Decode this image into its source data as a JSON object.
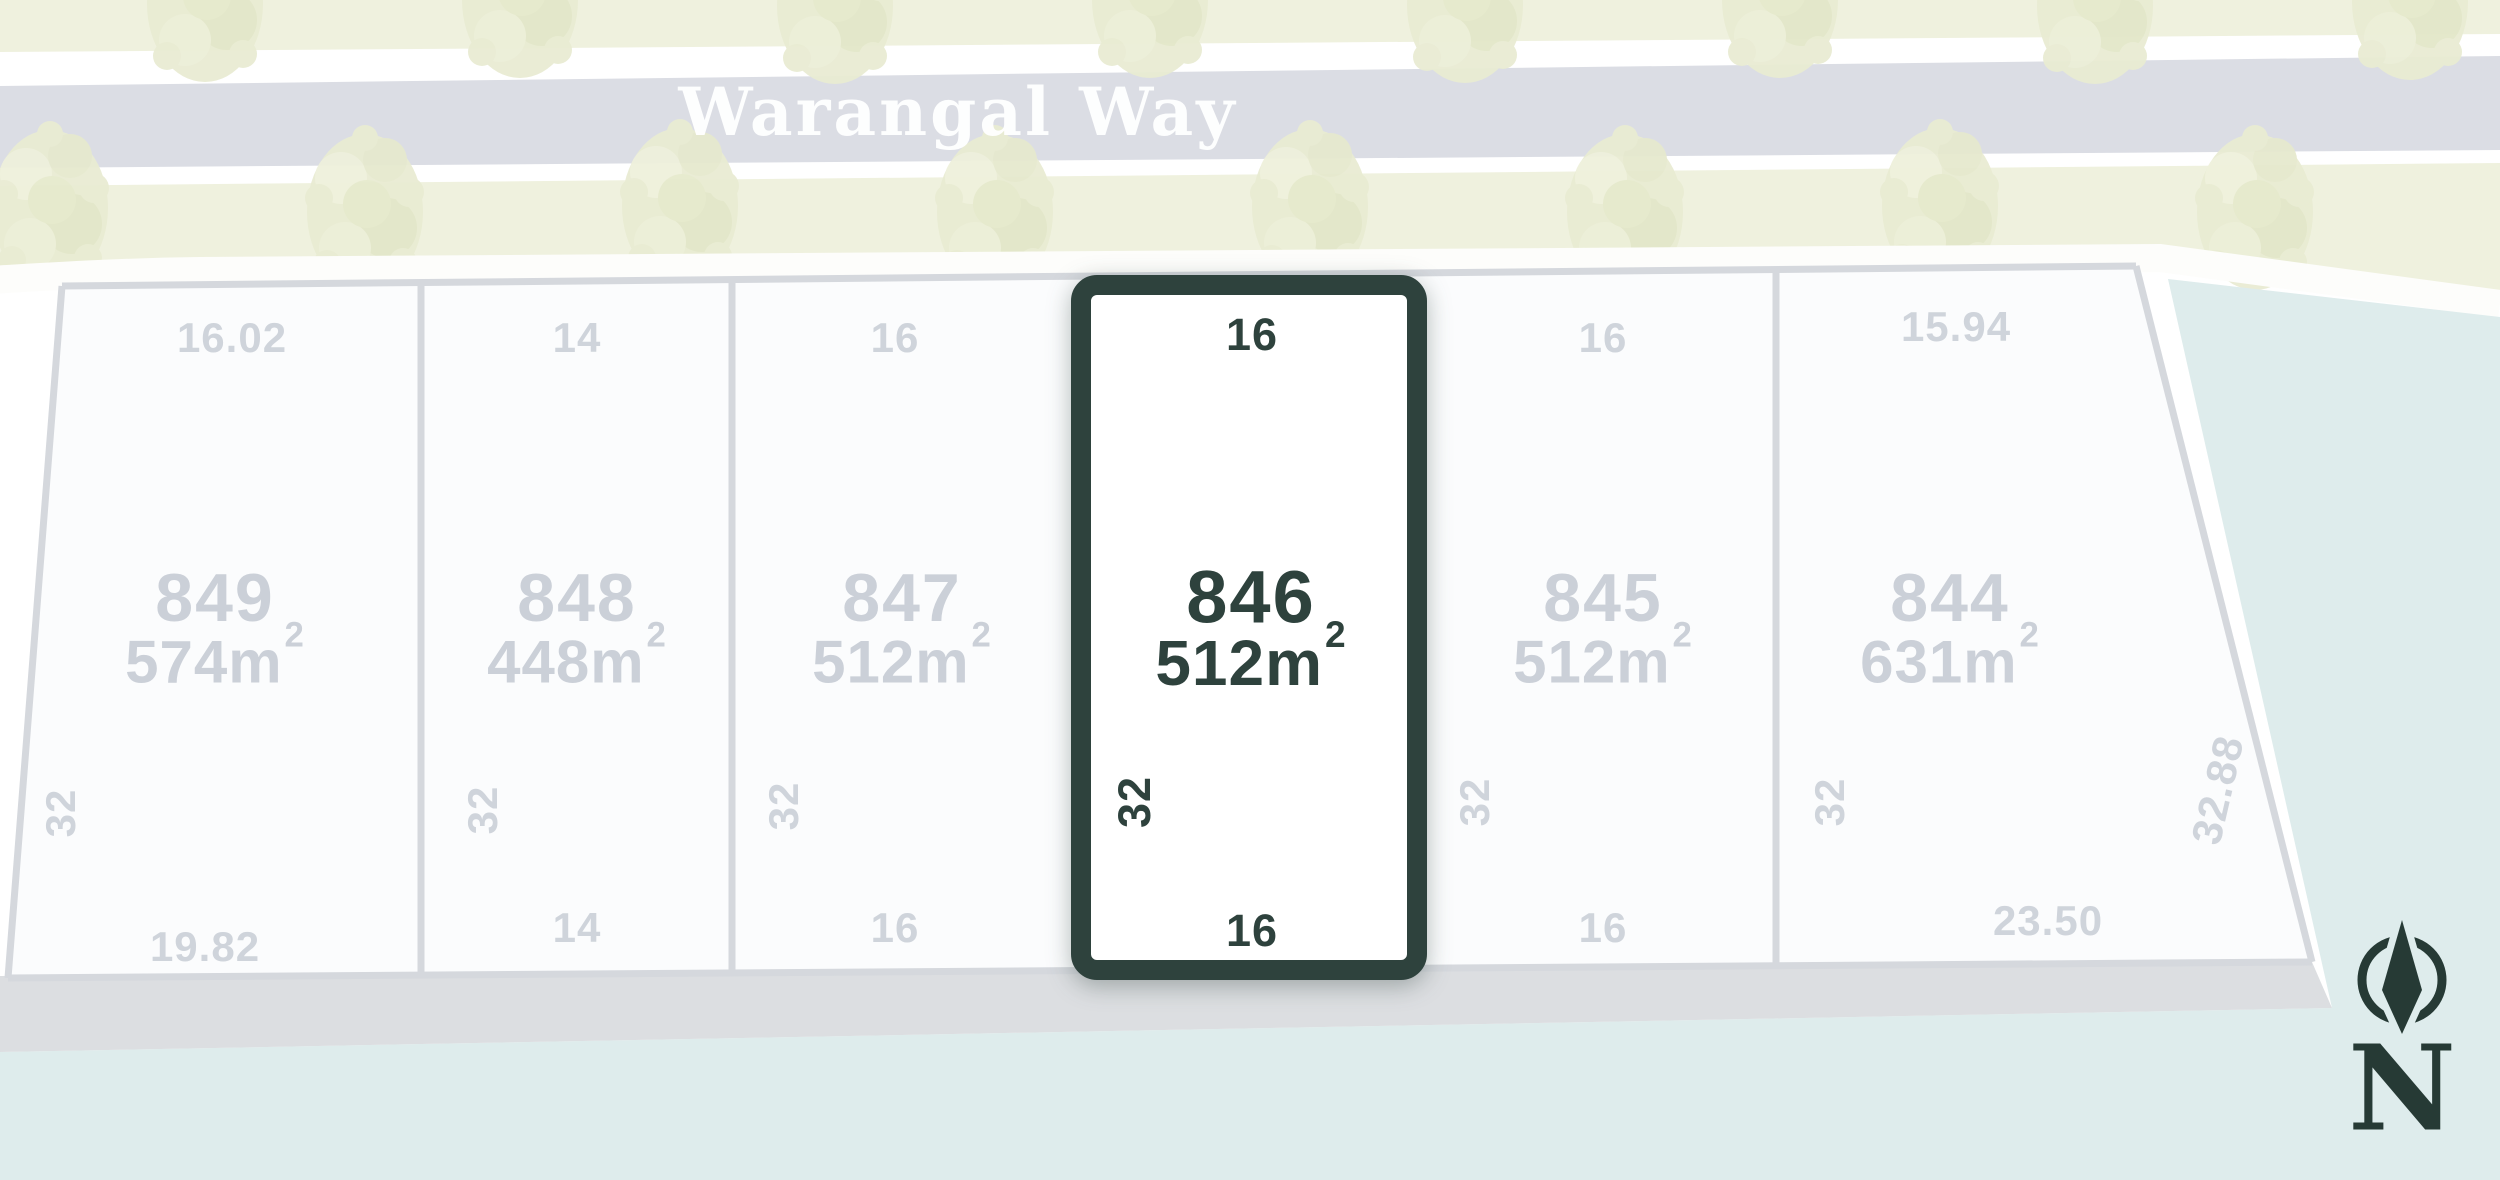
{
  "street": {
    "name": "Warangal Way"
  },
  "compass": {
    "label": "N",
    "icon": "compass-needle-icon"
  },
  "lots": [
    {
      "number": "849",
      "area_value": "574",
      "area_unit": "m",
      "area_sup": "2",
      "dim_top": "16.02",
      "dim_bottom": "19.82",
      "dim_side": "32",
      "highlighted": false
    },
    {
      "number": "848",
      "area_value": "448",
      "area_unit": "m",
      "area_sup": "2",
      "dim_top": "14",
      "dim_bottom": "14",
      "dim_side": "32",
      "highlighted": false
    },
    {
      "number": "847",
      "area_value": "512",
      "area_unit": "m",
      "area_sup": "2",
      "dim_top": "16",
      "dim_bottom": "16",
      "dim_side": "32",
      "highlighted": false
    },
    {
      "number": "846",
      "area_value": "512",
      "area_unit": "m",
      "area_sup": "2",
      "dim_top": "16",
      "dim_bottom": "16",
      "dim_side": "32",
      "highlighted": true
    },
    {
      "number": "845",
      "area_value": "512",
      "area_unit": "m",
      "area_sup": "2",
      "dim_top": "16",
      "dim_bottom": "16",
      "dim_side": "32",
      "highlighted": false
    },
    {
      "number": "844",
      "area_value": "631",
      "area_unit": "m",
      "area_sup": "2",
      "dim_top": "15.94",
      "dim_bottom": "23.50",
      "dim_side": "32",
      "dim_side_right": "32.88",
      "highlighted": false
    }
  ],
  "colors": {
    "highlight_dark_teal": "#2e423d",
    "compass_dark": "#263a35",
    "water_blue": "#deecec",
    "road_gray": "#dbdde4",
    "verge_green": "#eff1de",
    "footpath_white": "#fdfdfb",
    "lot_line_gray": "#d5d8dd",
    "rear_band_gray": "#dcdee1",
    "faded_text_gray": "#cbd0d8",
    "street_text": "#ffffff"
  }
}
